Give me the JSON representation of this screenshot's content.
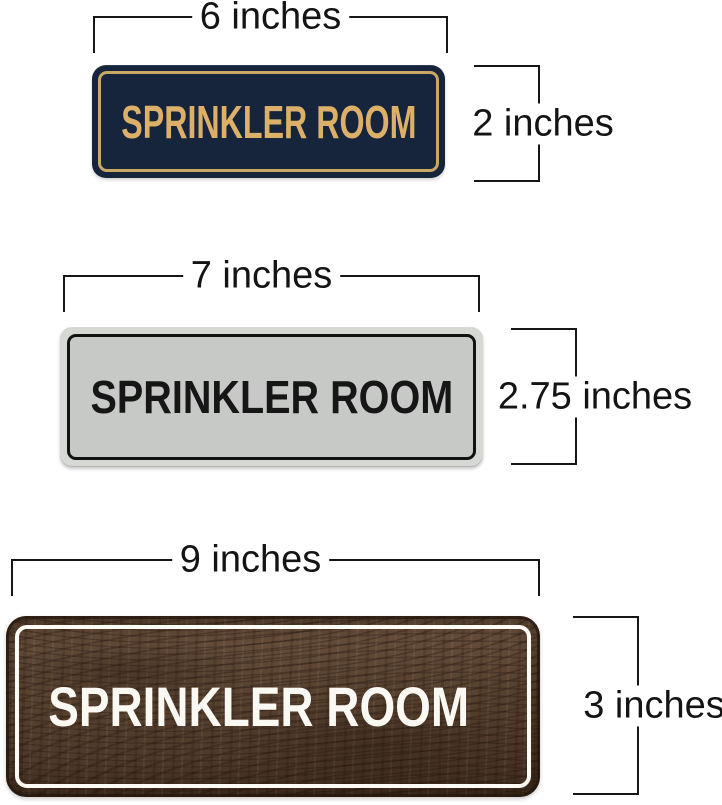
{
  "canvas": {
    "background": "#ffffff",
    "dimension_line_color": "#161616",
    "description": "Size comparison of three SPRINKLER ROOM door signs with measurement brackets"
  },
  "signs": [
    {
      "style": "navy-gold",
      "text": "SPRINKLER ROOM",
      "width_label": "6 inches",
      "height_label": "2 inches",
      "colors": {
        "background": "#16243c",
        "border": "#c9a765",
        "text": "#dcb068"
      }
    },
    {
      "style": "silver-black",
      "text": "SPRINKLER ROOM",
      "width_label": "7 inches",
      "height_label": "2.75 inches",
      "colors": {
        "frame": "#d6d8d4",
        "panel": "#c6c9c5",
        "border": "#121212",
        "text": "#161616"
      }
    },
    {
      "style": "walnut-white",
      "text": "SPRINKLER ROOM",
      "width_label": "9 inches",
      "height_label": "3 inches",
      "colors": {
        "wood": "#56402e",
        "border": "#fbfaf5",
        "text": "#faf8f2"
      }
    }
  ]
}
